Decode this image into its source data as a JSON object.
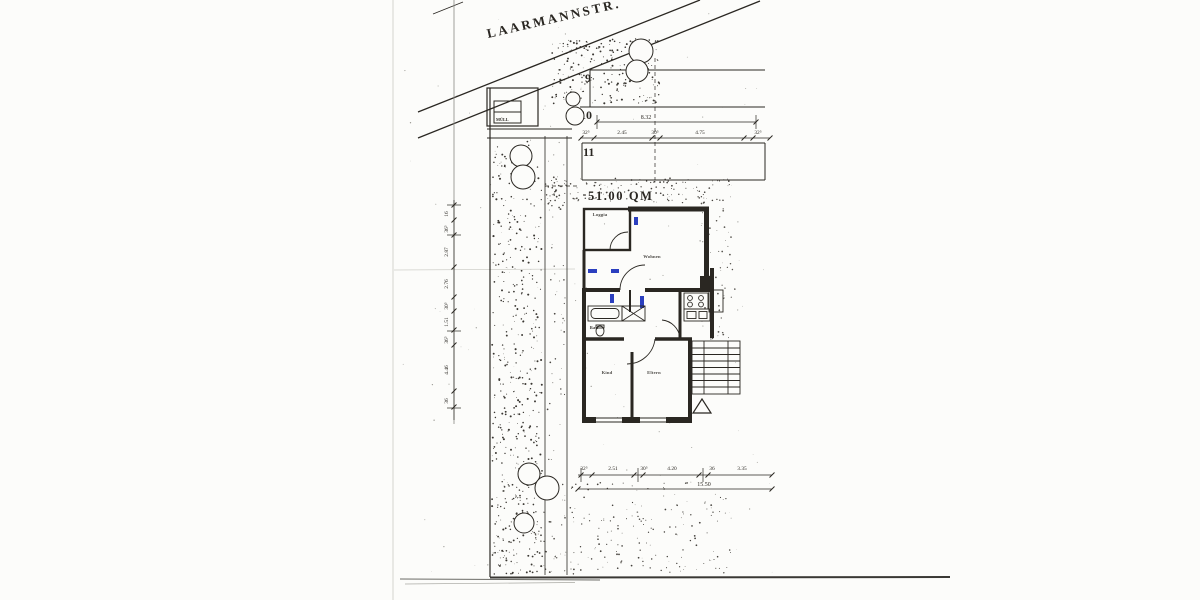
{
  "colors": {
    "ink": "#2a2722",
    "blue": "#2b3fbf",
    "paper": "#fcfcfa"
  },
  "street": {
    "label": "LAARMANNSTR."
  },
  "site": {
    "muell_label": "MÜLL",
    "area_label": "51.00 QM",
    "parcels": [
      "9",
      "10",
      "11"
    ]
  },
  "rooms": {
    "loggia": "Loggia",
    "wohnen": "Wohnen",
    "kind": "Kind",
    "eltern": "Eltern",
    "bad": "Bad"
  },
  "dims": {
    "top": {
      "total": "8.32",
      "segments": [
        "32⁵",
        "2.45",
        "30⁵",
        "4.75",
        "32⁵"
      ]
    },
    "bottom": {
      "total": "15.50",
      "segments": [
        "32⁵",
        "2.51",
        "30⁵",
        "4.20",
        "36",
        "3.35"
      ]
    },
    "left": {
      "segments": [
        "16",
        "36⁵",
        "2.87",
        "2.76",
        "30⁵",
        "1.51",
        "36⁵",
        "4.46",
        "36"
      ]
    }
  }
}
